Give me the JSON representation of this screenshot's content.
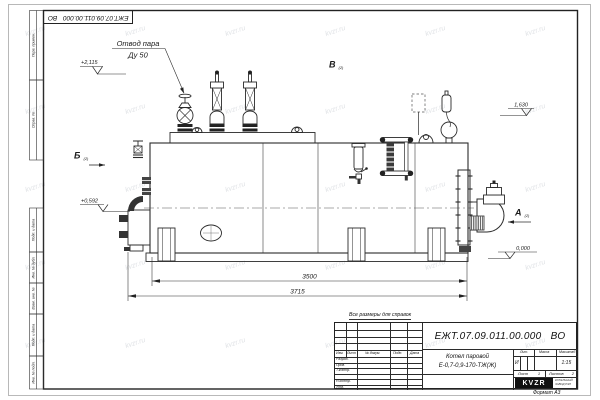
{
  "page": {
    "watermark": "kvzr.ru",
    "format_note": "Формат А3",
    "reference_note": "Все размеры для справок"
  },
  "doc": {
    "number": "ЕЖТ.07.09.011.00.000 ВО",
    "product": "Котел паровой",
    "model": "Е-0,7-0,9-170-ТЖ(Ж)",
    "litera": "И",
    "scale": "1:15",
    "sheet_number": "1",
    "sheets_total": "2"
  },
  "title_block": {
    "col_izm": "Изм.",
    "col_list": "Лист",
    "col_docnum": "№ докум.",
    "col_podp": "Подп.",
    "col_data": "Дата",
    "row_razrab": "Разраб.",
    "row_prov": "Пров.",
    "row_tkontr": "Т.контр.",
    "row_nkontr": "Н.контр.",
    "row_utv": "Утв.",
    "lbl_lit": "Лит.",
    "lbl_massa": "Масса",
    "lbl_masshtab": "Масштаб",
    "lbl_list": "Лист",
    "lbl_listov": "Листов",
    "logo_text": "KVZR",
    "logo_sub1": "КОТЕЛЬНЫЙ",
    "logo_sub2": "ЗАВОД РЭП"
  },
  "margin_stamps": {
    "perv_primen": "Перв. примен.",
    "sprav_no": "Справ. №",
    "podp_data1": "Подп. и дата",
    "inv_dubl": "Инв. № дубл.",
    "vzam_inv": "Взам. инв. №",
    "podp_data2": "Подп. и дата",
    "inv_podl": "Инв. № подл."
  },
  "drawing": {
    "callout_line1": "Отвод пара",
    "callout_line2": "Ду 50",
    "view_a": "А",
    "view_b": "Б",
    "view_v": "В",
    "view_ref": "(2)",
    "elev_steam": "+2,115",
    "elev_right": "1,630",
    "elev_left": "+0,592",
    "elev_zero": "0,000",
    "dim_body": "3500",
    "dim_overall": "3715"
  }
}
